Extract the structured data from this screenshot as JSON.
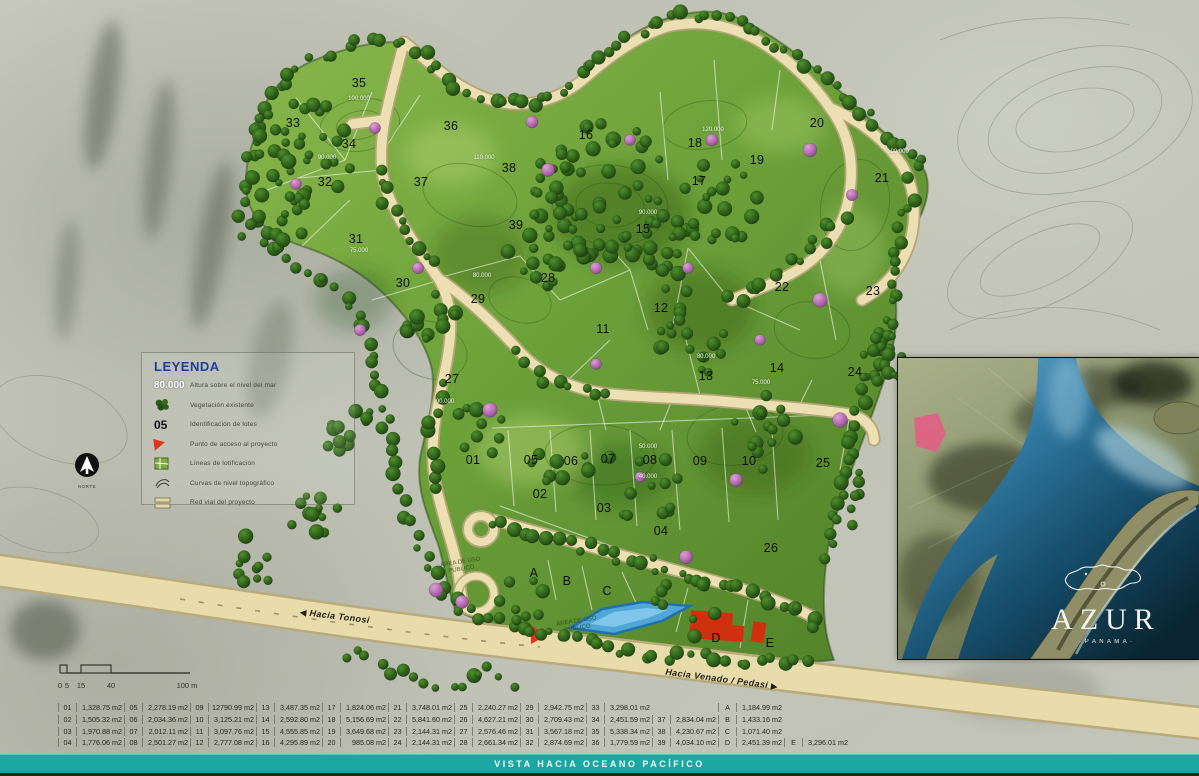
{
  "footer": {
    "text": "VISTA HACIA OCEANO PACÍFICO"
  },
  "legend": {
    "title": "LEYENDA",
    "items": [
      {
        "icon": "elevation-sample",
        "sample": "80.000",
        "label": "Altura sobre el nivel del mar"
      },
      {
        "icon": "vegetation",
        "sample": "",
        "label": "Vegetación existente"
      },
      {
        "icon": "lot-id-sample",
        "sample": "05",
        "label": "Identificación de lotes"
      },
      {
        "icon": "access-point",
        "sample": "",
        "label": "Punto de acceso al proyecto"
      },
      {
        "icon": "lot-lines",
        "sample": "",
        "label": "Líneas de lotificación"
      },
      {
        "icon": "contours",
        "sample": "",
        "label": "Curvas de nivel topográfico"
      },
      {
        "icon": "road-network",
        "sample": "",
        "label": "Red vial del proyecto"
      }
    ]
  },
  "north": {
    "label": "NORTE"
  },
  "scalebar": {
    "ticks": [
      "0",
      "5",
      "15",
      "40",
      "100 m"
    ]
  },
  "roads": {
    "left_label": "Hacia Tonosi",
    "right_label": "Hacia Venado / Pedasi"
  },
  "map": {
    "lots": [
      {
        "id": "01",
        "x": 473,
        "y": 460
      },
      {
        "id": "02",
        "x": 540,
        "y": 494
      },
      {
        "id": "03",
        "x": 604,
        "y": 508
      },
      {
        "id": "04",
        "x": 661,
        "y": 531
      },
      {
        "id": "05",
        "x": 531,
        "y": 460
      },
      {
        "id": "06",
        "x": 571,
        "y": 461
      },
      {
        "id": "07",
        "x": 608,
        "y": 459
      },
      {
        "id": "08",
        "x": 650,
        "y": 460
      },
      {
        "id": "09",
        "x": 700,
        "y": 461
      },
      {
        "id": "10",
        "x": 749,
        "y": 461
      },
      {
        "id": "11",
        "x": 603,
        "y": 329
      },
      {
        "id": "12",
        "x": 661,
        "y": 308
      },
      {
        "id": "13",
        "x": 706,
        "y": 376
      },
      {
        "id": "14",
        "x": 777,
        "y": 368
      },
      {
        "id": "15",
        "x": 643,
        "y": 229
      },
      {
        "id": "16",
        "x": 586,
        "y": 135
      },
      {
        "id": "17",
        "x": 699,
        "y": 181
      },
      {
        "id": "18",
        "x": 695,
        "y": 143
      },
      {
        "id": "19",
        "x": 757,
        "y": 160
      },
      {
        "id": "20",
        "x": 817,
        "y": 123
      },
      {
        "id": "21",
        "x": 882,
        "y": 178
      },
      {
        "id": "22",
        "x": 782,
        "y": 287
      },
      {
        "id": "23",
        "x": 873,
        "y": 291
      },
      {
        "id": "24",
        "x": 855,
        "y": 372
      },
      {
        "id": "25",
        "x": 823,
        "y": 463
      },
      {
        "id": "26",
        "x": 771,
        "y": 548
      },
      {
        "id": "27",
        "x": 452,
        "y": 379
      },
      {
        "id": "28",
        "x": 548,
        "y": 278
      },
      {
        "id": "29",
        "x": 478,
        "y": 299
      },
      {
        "id": "30",
        "x": 403,
        "y": 283
      },
      {
        "id": "31",
        "x": 356,
        "y": 239
      },
      {
        "id": "32",
        "x": 325,
        "y": 182
      },
      {
        "id": "33",
        "x": 293,
        "y": 123
      },
      {
        "id": "34",
        "x": 349,
        "y": 144
      },
      {
        "id": "35",
        "x": 359,
        "y": 83
      },
      {
        "id": "36",
        "x": 451,
        "y": 126
      },
      {
        "id": "37",
        "x": 421,
        "y": 182
      },
      {
        "id": "38",
        "x": 509,
        "y": 168
      },
      {
        "id": "39",
        "x": 516,
        "y": 225
      },
      {
        "id": "A",
        "x": 534,
        "y": 573
      },
      {
        "id": "B",
        "x": 567,
        "y": 581
      },
      {
        "id": "C",
        "x": 607,
        "y": 591
      },
      {
        "id": "D",
        "x": 716,
        "y": 638
      },
      {
        "id": "E",
        "x": 770,
        "y": 643
      }
    ],
    "elevations": [
      {
        "v": "100.000",
        "x": 359,
        "y": 99
      },
      {
        "v": "90.000",
        "x": 327,
        "y": 158
      },
      {
        "v": "110.000",
        "x": 484,
        "y": 158
      },
      {
        "v": "75.000",
        "x": 359,
        "y": 251
      },
      {
        "v": "120.000",
        "x": 713,
        "y": 130
      },
      {
        "v": "90.000",
        "x": 648,
        "y": 213
      },
      {
        "v": "100.000",
        "x": 898,
        "y": 152
      },
      {
        "v": "80.000",
        "x": 482,
        "y": 276
      },
      {
        "v": "90.000",
        "x": 445,
        "y": 402
      },
      {
        "v": "80.000",
        "x": 706,
        "y": 357
      },
      {
        "v": "75.000",
        "x": 761,
        "y": 383
      },
      {
        "v": "50.000",
        "x": 648,
        "y": 447
      },
      {
        "v": "40.000",
        "x": 648,
        "y": 477
      }
    ],
    "area_labels": [
      {
        "text": "ÁREA DE USO PÚBLICO",
        "x": 461,
        "y": 566
      },
      {
        "text": "ÁREA DE USO PÚBLICO",
        "x": 577,
        "y": 625
      }
    ]
  },
  "table": {
    "groups": [
      [
        {
          "n": "01",
          "v": "1,328.75 m2"
        },
        {
          "n": "02",
          "v": "1,505.32 m2"
        },
        {
          "n": "03",
          "v": "1,970.88 m2"
        },
        {
          "n": "04",
          "v": "1,776.06 m2"
        }
      ],
      [
        {
          "n": "05",
          "v": "2,278.19 m2"
        },
        {
          "n": "06",
          "v": "2,034.36 m2"
        },
        {
          "n": "07",
          "v": "2,012.11 m2"
        },
        {
          "n": "08",
          "v": "2,501.27 m2"
        }
      ],
      [
        {
          "n": "09",
          "v": "12790.99 m2"
        },
        {
          "n": "10",
          "v": "3,125.21 m2"
        },
        {
          "n": "11",
          "v": "3,097.76 m2"
        },
        {
          "n": "12",
          "v": "2,777.08 m2"
        }
      ],
      [
        {
          "n": "13",
          "v": "3,487.35 m2"
        },
        {
          "n": "14",
          "v": "2,592.80 m2"
        },
        {
          "n": "15",
          "v": "4,555.85 m2"
        },
        {
          "n": "16",
          "v": "4,295.89 m2"
        }
      ],
      [
        {
          "n": "17",
          "v": "1,824.06 m2"
        },
        {
          "n": "18",
          "v": "5,156.69 m2"
        },
        {
          "n": "19",
          "v": "3,649.68 m2"
        },
        {
          "n": "20",
          "v": "985.08 m2"
        }
      ],
      [
        {
          "n": "21",
          "v": "3,748.01 m2"
        },
        {
          "n": "22",
          "v": "5,841.60 m2"
        },
        {
          "n": "23",
          "v": "2,144.31 m2"
        },
        {
          "n": "24",
          "v": "2,144.31 m2"
        }
      ],
      [
        {
          "n": "25",
          "v": "2,240.27 m2"
        },
        {
          "n": "26",
          "v": "4,627.21 m2"
        },
        {
          "n": "27",
          "v": "2,576.46 m2"
        },
        {
          "n": "28",
          "v": "2,661.34 m2"
        }
      ],
      [
        {
          "n": "29",
          "v": "2,942.75 m2"
        },
        {
          "n": "30",
          "v": "2,709.43 m2"
        },
        {
          "n": "31",
          "v": "3,567.18 m2"
        },
        {
          "n": "32",
          "v": "2,874.69 m2"
        }
      ],
      [
        {
          "n": "33",
          "v": "3,298.01 m2"
        },
        {
          "n": "34",
          "v": "2,451.59 m2"
        },
        {
          "n": "35",
          "v": "5,338.34 m2"
        },
        {
          "n": "36",
          "v": "1,779.59 m2"
        }
      ],
      [
        {
          "n": "",
          "v": ""
        },
        {
          "n": "37",
          "v": "2,834.04 m2"
        },
        {
          "n": "38",
          "v": "4,230.67 m2"
        },
        {
          "n": "39",
          "v": "4,034.10 m2"
        }
      ],
      [
        {
          "n": "A",
          "v": "1,184.99 m2"
        },
        {
          "n": "B",
          "v": "1,433.16 m2"
        },
        {
          "n": "C",
          "v": "1,071.40 m2"
        },
        {
          "n": "D",
          "v": "2,451.39 m2"
        }
      ],
      [
        {
          "n": "",
          "v": ""
        },
        {
          "n": "",
          "v": ""
        },
        {
          "n": "",
          "v": ""
        },
        {
          "n": "E",
          "v": "3,296.01 m2"
        }
      ]
    ]
  },
  "inset": {
    "brand": "AZUR",
    "brand_sub": "· P A N A M A ·"
  },
  "colors": {
    "footer_teal": "#1ba7a2",
    "road_beige": "#e9dcab",
    "road_casing": "#b8ab7c",
    "terrain_light": "#8ab74c",
    "terrain_dark": "#4f7f28",
    "tree_dark": "#224d14",
    "flower_tree_pink": "#bd72b8",
    "access_red": "#e8311c",
    "water_blue": "#4fa8e0",
    "legend_title_blue": "#1d3f9e",
    "site_marker_pink": "#e25f84"
  }
}
